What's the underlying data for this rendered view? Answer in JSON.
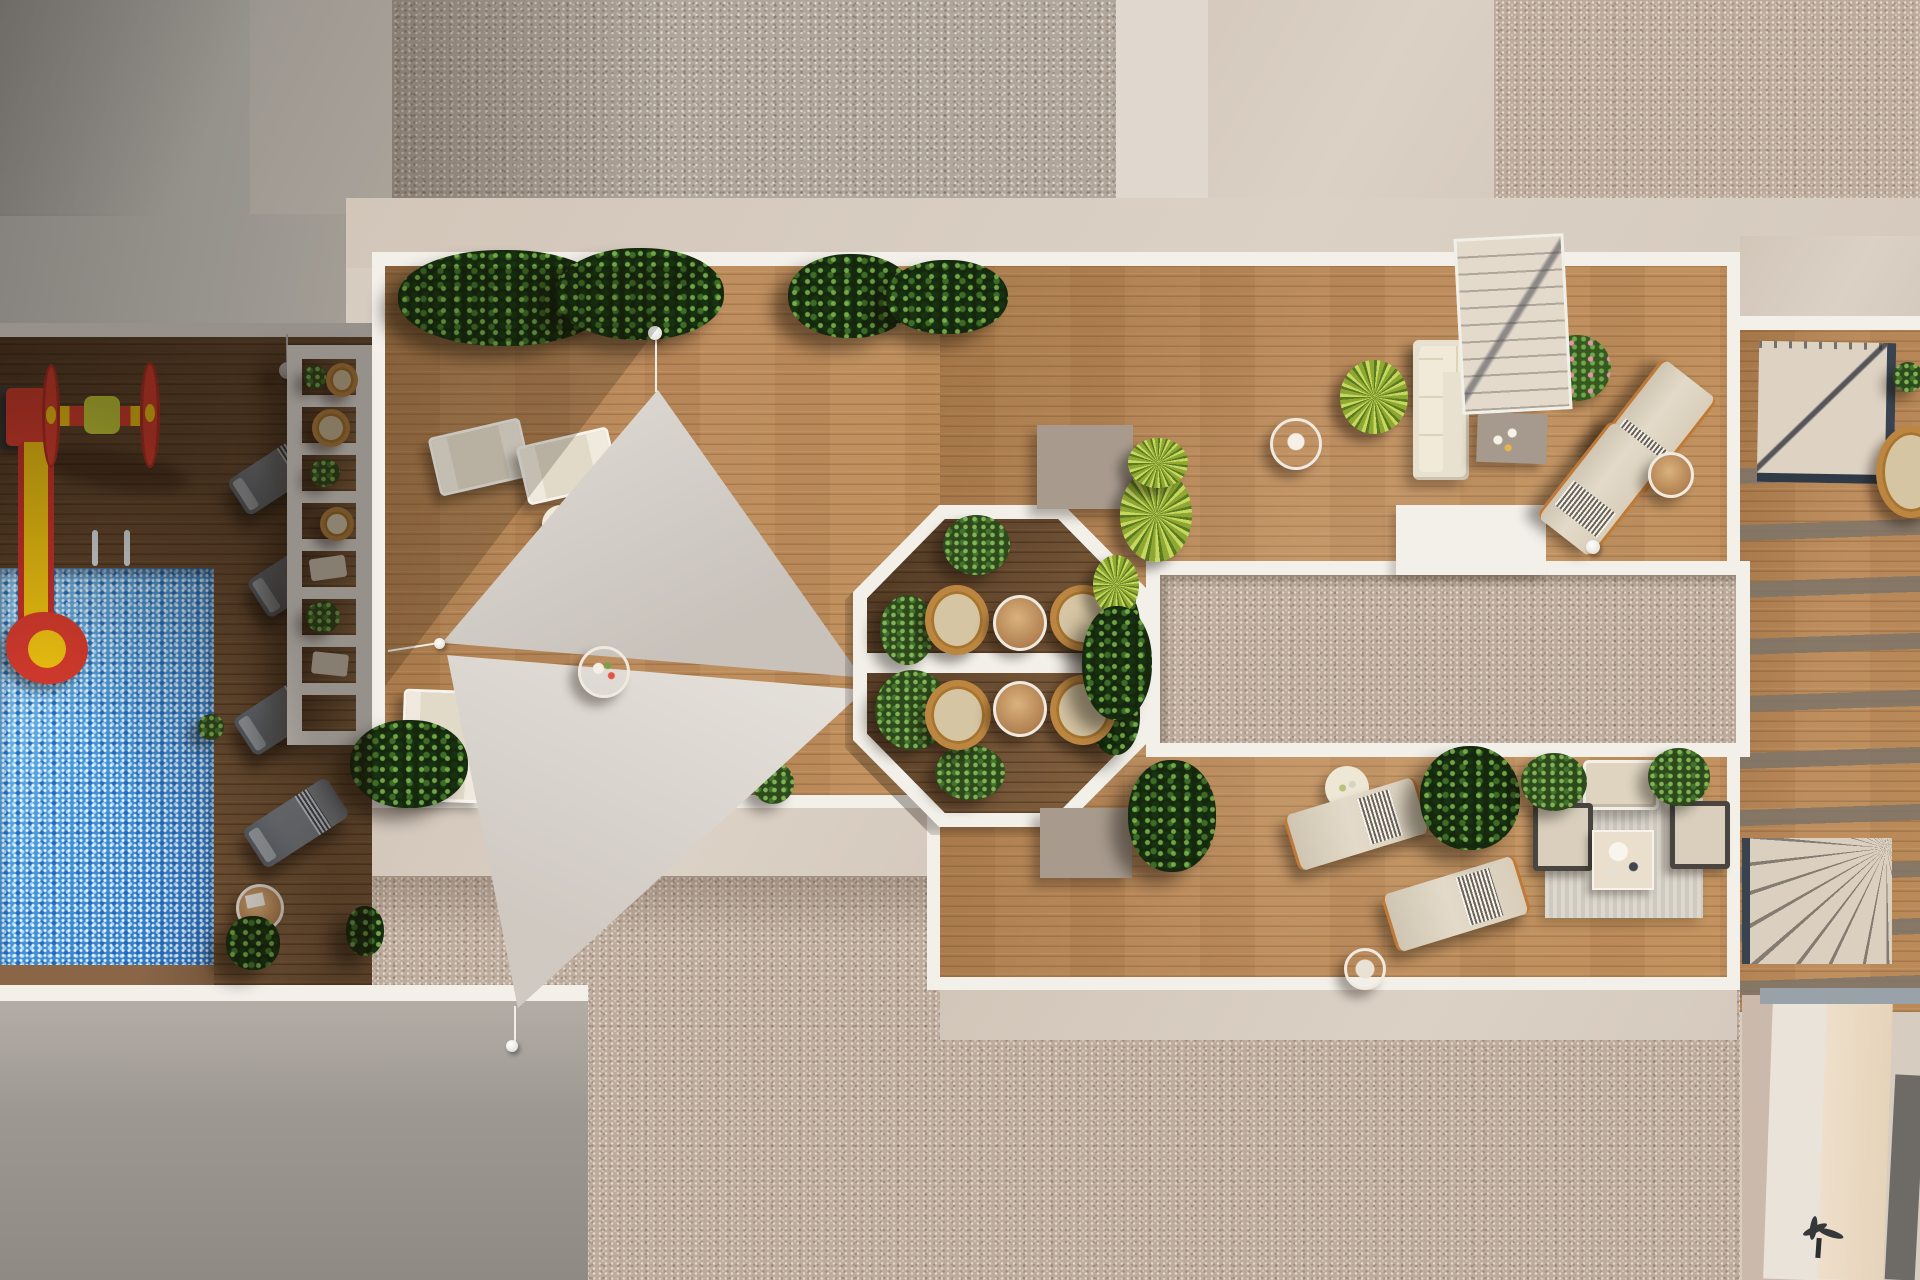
{
  "scene": {
    "description": "Aerial 3D architectural render of a residential rooftop amenity terrace with pool, playground, shade sails, pergola, octagonal seating nook and lounge areas",
    "areas": {
      "pool": "Swimming pool",
      "playground": "Kids playground with slide and roller spinner",
      "pool_loungers": "Poolside sun loungers",
      "pergola": "White slatted pergola",
      "shade_sails": "Shade sail lounge deck",
      "octagon": "Octagonal planted seating nook",
      "skylight": "Gravel skylight strip",
      "sofa_lounge": "Corner sofa lounge",
      "sun_deck": "Sun lounger deck",
      "lounge_rug": "Outdoor lounge set on rug",
      "stairs": "Roof access stairs",
      "gravel_roof": "Gravel roof field",
      "street": "Ground-level pavement",
      "deck": "Timber deck"
    },
    "palette": {
      "pool_blue": "#3f8fd4",
      "deck_wood": "#b8885a",
      "deck_wood_shadow": "#5e4530",
      "gravel": "#b0a69b",
      "gravel_warm": "#bdac9d",
      "concrete_beige": "#d7ccc0",
      "concrete_gray": "#93908a",
      "frame_white": "#f3f0ea",
      "sail_gray": "#d9d4ce",
      "plant_green": "#24401a",
      "accent_red": "#d93b2e",
      "accent_yellow": "#f2c511",
      "rattan": "#bc8640",
      "cushion_cream": "#e9e1cf",
      "lounger_gray": "#828a93"
    }
  }
}
